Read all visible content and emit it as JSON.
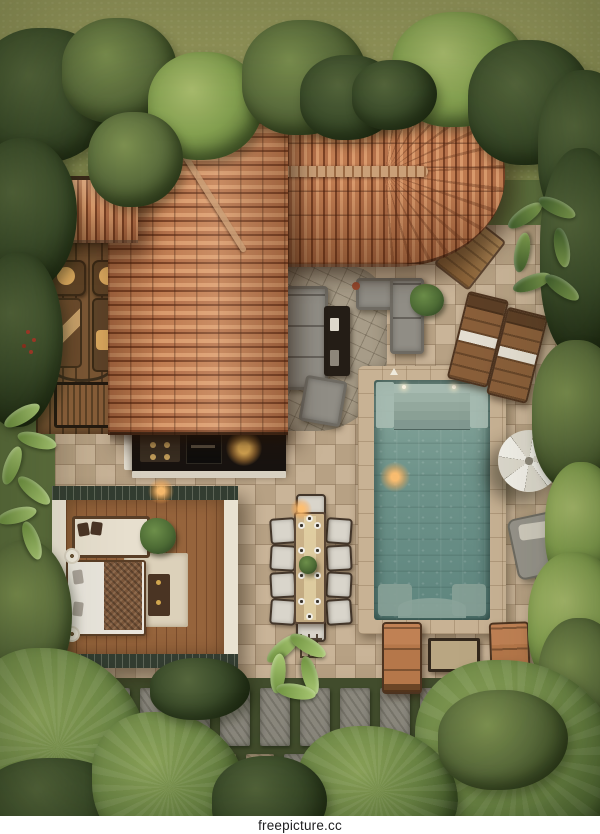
{
  "watermark": {
    "text": "freepicture.cc"
  },
  "palette": {
    "lawn": "#9a9b5f",
    "foliage": "#5c6e3d",
    "roof": "#b5714a",
    "roof-dark": "#7c4326",
    "roof-light": "#d99a6c",
    "ridge": "#caa078",
    "patio": "#c3ad90",
    "stone-mosaic": "#a79c88",
    "pool-water": "#6e938a",
    "pool-deep": "#5e857e",
    "coping": "#c8b294",
    "deck-wood": "#7b5735",
    "sofa": "#908d85",
    "table-dark": "#241d16",
    "cushion-tan": "#dca95f",
    "lounger-pad": "#8a5f3a",
    "lounger-tan": "#b5774a",
    "umbrella": "#f1efe8",
    "daybed": "#96938a",
    "bedroom-wall": "#e9e2d1",
    "bedroom-edge": "#333d31",
    "floor-wood": "#96643c",
    "bed-linen": "#eae6dd",
    "blanket": "#7b573b",
    "rug": "#dcd1ba",
    "dining-chair": "#d9d5cb",
    "dining-table": "#cdb48b",
    "path-stone": "#8b887d",
    "path-tan": "#ab9a7c",
    "greenery-gap": "#414c2c",
    "watermark-bg": "#ffffff",
    "watermark-text": "#1d1d1f"
  }
}
